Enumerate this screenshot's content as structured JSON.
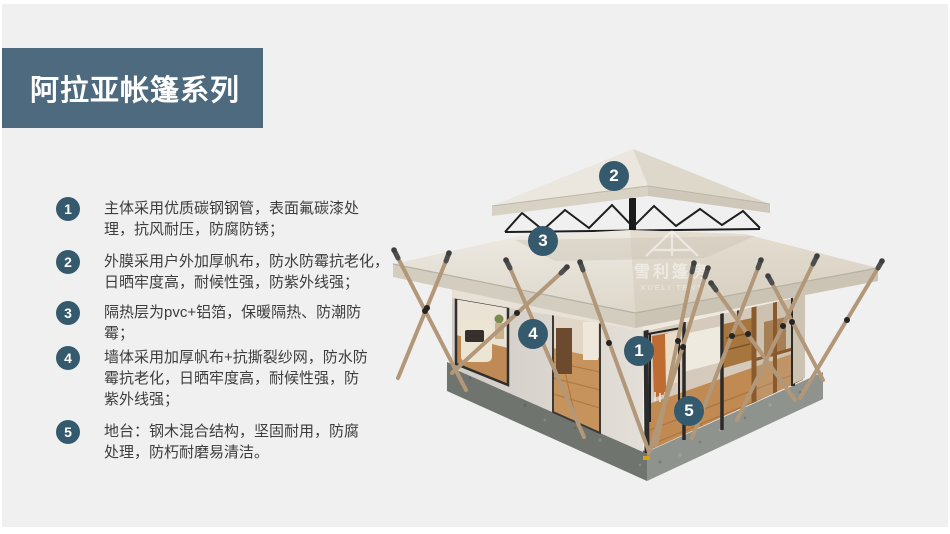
{
  "page": {
    "background": "#f0f0f0",
    "accent": "#35596d",
    "banner_color": "#4e6a7e"
  },
  "header": {
    "title": "阿拉亚帐篷系列"
  },
  "features": [
    {
      "num": "1",
      "lines": [
        "主体采用优质碳钢钢管，表面氟碳漆处",
        "理，抗风耐压，防腐防锈；"
      ]
    },
    {
      "num": "2",
      "lines": [
        "外膜采用户外加厚帆布，防水防霉抗老化，",
        "日晒牢度高，耐候性强，防紫外线强；"
      ]
    },
    {
      "num": "3",
      "lines": [
        "隔热层为pvc+铝箔，保暖隔热、防潮防",
        "霉；"
      ]
    },
    {
      "num": "4",
      "lines": [
        "墙体采用加厚帆布+抗撕裂纱网，防水防",
        "霉抗老化，日晒牢度高，耐候性强，防",
        "紫外线强；"
      ]
    },
    {
      "num": "5",
      "lines": [
        "地台：钢木混合结构，坚固耐用，防腐",
        "处理，防朽耐磨易清洁。"
      ]
    }
  ],
  "callouts": {
    "c1": "1",
    "c2": "2",
    "c3": "3",
    "c4": "4",
    "c5": "5"
  },
  "watermark": {
    "cn": "雪利篷房",
    "en": "XUELI TENT"
  }
}
